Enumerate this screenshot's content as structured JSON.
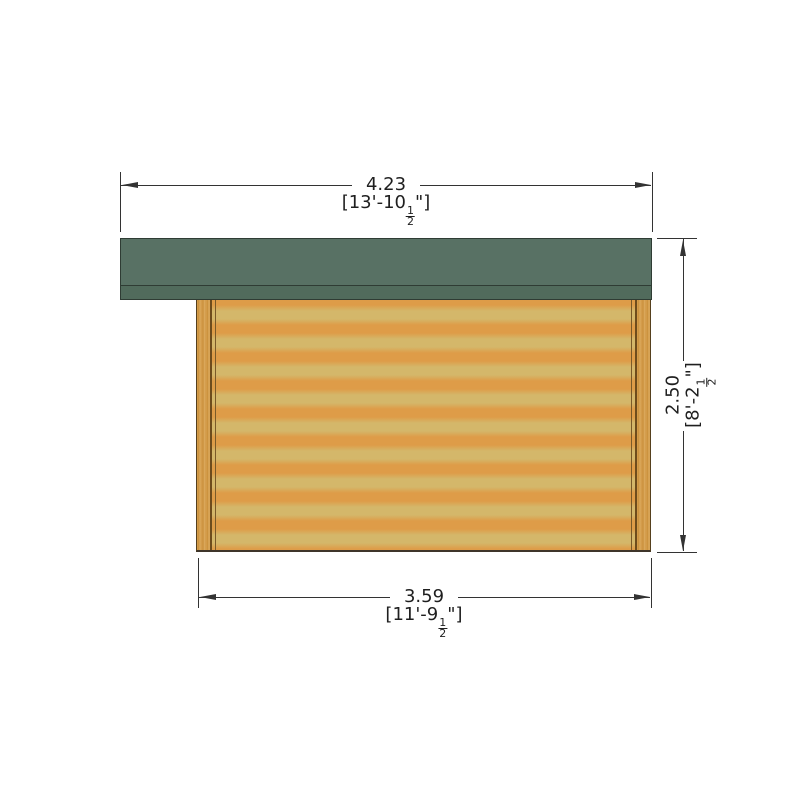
{
  "page": {
    "background": "#ffffff"
  },
  "drawing": {
    "type": "cabin-side-elevation",
    "colors": {
      "roof": "#587164",
      "roof_fascia": "#516b5c",
      "wall_light": "#d4b76a",
      "wall_stripe": "#de9c48",
      "corner_joint_line": "#6e4c1c",
      "dimension_line": "#333333"
    }
  },
  "dimensions": {
    "top": {
      "metric": "4.23",
      "imperial_prefix": "[13'-10",
      "fraction_numerator": "1",
      "fraction_denominator": "2",
      "imperial_suffix": "\"]"
    },
    "right": {
      "metric": "2.50",
      "imperial_prefix": "[8'-2",
      "fraction_numerator": "1",
      "fraction_denominator": "2",
      "imperial_suffix": "\"]"
    },
    "bottom": {
      "metric": "3.59",
      "imperial_prefix": "[11'-9",
      "fraction_numerator": "1",
      "fraction_denominator": "2",
      "imperial_suffix": "\"]"
    }
  }
}
